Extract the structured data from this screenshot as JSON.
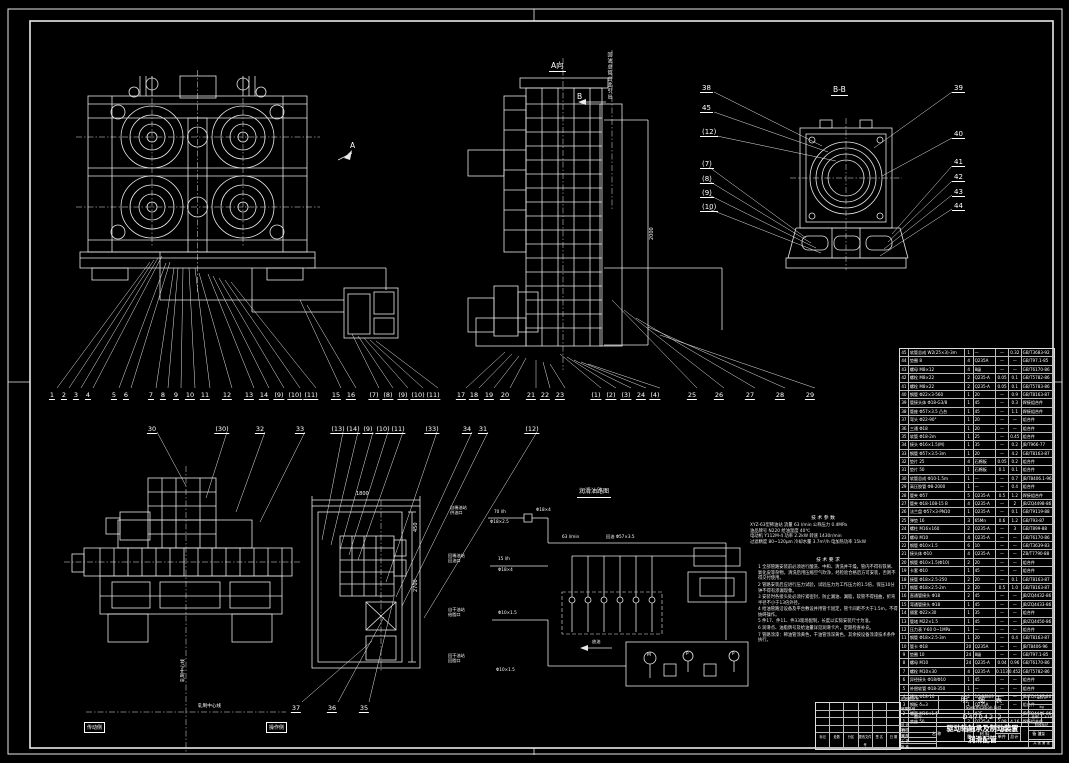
{
  "labels": {
    "view_a_title": "A向",
    "view_a_arrow": "A",
    "section_b_mark": "B",
    "section_bb_title": "B-B",
    "vertical_note": "回油总管由此引出",
    "schematic_title": "润滑油路图",
    "drain": "放油",
    "pump_m": "M",
    "pump_p1": "P",
    "pump_p2": "P",
    "dim_panel_width": "1800",
    "dim_panel_height": "2700",
    "dim_panel_top": "450",
    "dim_tower": "2000",
    "centerline_h": "轧制中心线",
    "centerline_v": "轧制中心线",
    "side_left_box": "传动侧",
    "side_right_box": "操作侧"
  },
  "balloons": {
    "row1": [
      "1",
      "2",
      "3",
      "4",
      "5",
      "6",
      "7",
      "8",
      "9",
      "10",
      "11",
      "12",
      "13",
      "14",
      "(9)",
      "(10)",
      "(11)",
      "15",
      "16",
      "(7)",
      "(8)",
      "(9)",
      "(10)",
      "(11)",
      "17",
      "18",
      "19",
      "20",
      "21",
      "22",
      "23",
      "(1)",
      "(2)",
      "(3)",
      "24",
      "(4)",
      "25",
      "26",
      "27",
      "28",
      "29"
    ],
    "row2": [
      "30",
      "(30)",
      "32",
      "33",
      "(13)",
      "(14)",
      "(9)",
      "(10)",
      "(11)",
      "(33)",
      "34",
      "31",
      "(12)"
    ],
    "bottom": [
      "37",
      "36",
      "35"
    ],
    "bb_left": [
      "38",
      "45",
      "(12)",
      "(7)",
      "(8)",
      "(9)",
      "(10)"
    ],
    "bb_right": [
      "39",
      "40",
      "41",
      "42",
      "43",
      "44"
    ]
  },
  "tech_params": {
    "title": "技 术 参 数",
    "lines": [
      "XYZ-63型稀油站  流量 63 l/min  公称压力 0.4MPa",
      "油品牌号 N220  给油温度 40℃",
      "电动机 Y112M-4  功率 2.2kW  转速 1430r/min",
      "过滤精度 80~120μm  冷却水量 3.7m³/h  电加热功率 15kW"
    ]
  },
  "tech_notes": {
    "title": "技 术 要 求",
    "items": [
      "1 全部管路安装前必须进行酸洗、中和、清洗并干燥，管内不得有铁屑、氧化皮等杂物，清洗后用压缩空气吹净，经检验合格后方可安装，否则不得交付使用。",
      "2 管路安装后应进行压力试验，试验压力为工作压力的1.5倍，保压10分钟不得有渗漏现象。",
      "3 安装时各接头处必须拧紧密封，防止漏油、漏脂，软管不得扭曲，折弯半径不小于13倍外径。",
      "4 给油管路沿设备及平台敷设并用管卡固定，管卡间距不大于1.5m，不得妨碍操作。",
      "5 件17、件11、件33现场配制，长度以实际安装尺寸为准。",
      "6 润滑点、油脂牌号及给油量详见润滑卡片，定期检查补充。",
      "7 管路涂漆：稀油管涂黄色，干油管涂深黄色，其余按设备涂漆技术条件执行。"
    ]
  },
  "schematic": {
    "sources": [
      {
        "l1": "自稀油站",
        "l2": "供油口"
      },
      {
        "l1": "回稀油站",
        "l2": "回油口"
      },
      {
        "l1": "自干油站",
        "l2": "给脂口"
      },
      {
        "l1": "回干油站",
        "l2": "回脂口"
      }
    ],
    "flow_labels": {
      "f1": "70 l/h",
      "p1": "Φ18×2.5",
      "p2": "Φ18×4",
      "f2": "63 l/min",
      "p3": "回油 Φ57×3.5",
      "f3": "15 l/h",
      "p4": "Φ18×4",
      "p5": "Φ10×1.5",
      "p6": "Φ10×1.5"
    }
  },
  "parts_table": {
    "headers": {
      "no": "件号",
      "name": "名  称",
      "qty": "数量",
      "mat": "材 料",
      "wt": "重量 kg",
      "w1": "单件",
      "w2": "总计",
      "rem": "备  注"
    },
    "rows": [
      {
        "no": "45",
        "name": "软管总成 W2(25×3)-3m",
        "qty": "1",
        "mat": "—",
        "w1": "—",
        "w2": "0.32",
        "rem": "GB/T3683-92"
      },
      {
        "no": "44",
        "name": "垫圈 8",
        "qty": "4",
        "mat": "Q235A",
        "w1": "—",
        "w2": "—",
        "rem": "GB/T97.1-85"
      },
      {
        "no": "43",
        "name": "螺母 M8×12",
        "qty": "4",
        "mat": "8级",
        "w1": "—",
        "w2": "—",
        "rem": "GB/T6170-86"
      },
      {
        "no": "42",
        "name": "螺栓 M8×22",
        "qty": "2",
        "mat": "Q235-A",
        "w1": "0.05",
        "w2": "0.1",
        "rem": "GB/T5782-86"
      },
      {
        "no": "41",
        "name": "螺栓 M8×22",
        "qty": "2",
        "mat": "Q235-A",
        "w1": "0.05",
        "w2": "0.1",
        "rem": "GB/T5783-86"
      },
      {
        "no": "40",
        "name": "钢管 Φ22×3-560",
        "qty": "1",
        "mat": "20",
        "w1": "—",
        "w2": "0.9",
        "rem": "GB/T8163-87"
      },
      {
        "no": "39",
        "name": "管接头体 Φ18-G3/8",
        "qty": "1",
        "mat": "45",
        "w1": "—",
        "w2": "0.3",
        "rem": "焊接组合件"
      },
      {
        "no": "38",
        "name": "管座 Φ57×3.5 凸台",
        "qty": "1",
        "mat": "45",
        "w1": "—",
        "w2": "1.1",
        "rem": "焊接组合件"
      },
      {
        "no": "37",
        "name": "弯头 Φ22-90°",
        "qty": "1",
        "mat": "20",
        "w1": "—",
        "w2": "—",
        "rem": "组合件"
      },
      {
        "no": "36",
        "name": "三通 Φ18",
        "qty": "1",
        "mat": "20",
        "w1": "—",
        "w2": "—",
        "rem": "组合件"
      },
      {
        "no": "35",
        "name": "软管 Φ18-2m",
        "qty": "1",
        "mat": "25",
        "w1": "—",
        "w2": "0.45",
        "rem": "组合件"
      },
      {
        "no": "34",
        "name": "接头 Φ16×1.5(M)",
        "qty": "1",
        "mat": "35",
        "w1": "—",
        "w2": "0.2",
        "rem": "JB/T966-77"
      },
      {
        "no": "33",
        "name": "钢管 Φ57×3.5-3m",
        "qty": "1",
        "mat": "20",
        "w1": "—",
        "w2": "4.2",
        "rem": "GB/T8163-87"
      },
      {
        "no": "32",
        "name": "垫片 25",
        "qty": "4",
        "mat": "石棉板",
        "w1": "0.05",
        "w2": "0.2",
        "rem": "组合件"
      },
      {
        "no": "31",
        "name": "垫片 50",
        "qty": "1",
        "mat": "石棉板",
        "w1": "0.1",
        "w2": "0.1",
        "rem": "组合件"
      },
      {
        "no": "30",
        "name": "软管总成 Φ10-1.5m",
        "qty": "1",
        "mat": "—",
        "w1": "—",
        "w2": "0.7",
        "rem": "JB/T8406.1-96"
      },
      {
        "no": "29",
        "name": "高压胶管 Φ8-2000",
        "qty": "1",
        "mat": "—",
        "w1": "—",
        "w2": "0.4",
        "rem": "组合件"
      },
      {
        "no": "28",
        "name": "管夹 Φ57",
        "qty": "5",
        "mat": "Q235-A",
        "w1": "0.5",
        "w2": "1.2",
        "rem": "焊接组合件"
      },
      {
        "no": "27",
        "name": "管夹 Φ18-108-15 B",
        "qty": "4",
        "mat": "Q235-A",
        "w1": "—",
        "w2": "2",
        "rem": "JB/ZQ4498-86"
      },
      {
        "no": "26",
        "name": "法兰盘 Φ57×3-PN10",
        "qty": "1",
        "mat": "Q235-A",
        "w1": "—",
        "w2": "0.1",
        "rem": "GB/T9119-88"
      },
      {
        "no": "25",
        "name": "弹垫 16",
        "qty": "3",
        "mat": "65Mn",
        "w1": "0.6",
        "w2": "1.2",
        "rem": "GB/T93-87"
      },
      {
        "no": "24",
        "name": "螺柱 M16×160",
        "qty": "2",
        "mat": "Q235-A",
        "w1": "—",
        "w2": "3",
        "rem": "GB/T899-88"
      },
      {
        "no": "23",
        "name": "螺母 M10",
        "qty": "4",
        "mat": "Q235-A",
        "w1": "—",
        "w2": "—",
        "rem": "GB/T6170-86"
      },
      {
        "no": "22",
        "name": "钢管 Φ10×1.5",
        "qty": "6",
        "mat": "10",
        "w1": "—",
        "w2": "—",
        "rem": "GB/T3639-83"
      },
      {
        "no": "21",
        "name": "接头体 Φ10",
        "qty": "4",
        "mat": "Q235-A",
        "w1": "—",
        "w2": "—",
        "rem": "ZB/T7790-88"
      },
      {
        "no": "20",
        "name": "钢管 Φ10×1.5(Φ10)",
        "qty": "2",
        "mat": "20",
        "w1": "—",
        "w2": "—",
        "rem": "组合件"
      },
      {
        "no": "19",
        "name": "卡套 Φ10",
        "qty": "1",
        "mat": "45",
        "w1": "—",
        "w2": "—",
        "rem": "组合件"
      },
      {
        "no": "18",
        "name": "接管 Φ18×2.5-250",
        "qty": "2",
        "mat": "20",
        "w1": "—",
        "w2": "0.1",
        "rem": "GB/T8163-87"
      },
      {
        "no": "17",
        "name": "钢管 Φ18×2.5-2m",
        "qty": "2",
        "mat": "20",
        "w1": "0.5",
        "w2": "1.0",
        "rem": "GB/T8163-87"
      },
      {
        "no": "16",
        "name": "直通管接头 Φ18",
        "qty": "2",
        "mat": "45",
        "w1": "—",
        "w2": "—",
        "rem": "JB/ZQ4432-86"
      },
      {
        "no": "15",
        "name": "弯通管接头 Φ18",
        "qty": "1",
        "mat": "45",
        "w1": "—",
        "w2": "—",
        "rem": "JB/ZQ4433-86"
      },
      {
        "no": "14",
        "name": "隔套 Φ22×30",
        "qty": "1",
        "mat": "35",
        "w1": "—",
        "w2": "—",
        "rem": "组合件"
      },
      {
        "no": "13",
        "name": "管堵 M22×1.5",
        "qty": "1",
        "mat": "45",
        "w1": "—",
        "w2": "—",
        "rem": "JB/ZQ4450-86"
      },
      {
        "no": "12",
        "name": "压力表 Y-60 0~1MPa",
        "qty": "1",
        "mat": "—",
        "w1": "—",
        "w2": "—",
        "rem": "组合件"
      },
      {
        "no": "11",
        "name": "钢管 Φ18×2.5-3m",
        "qty": "1",
        "mat": "20",
        "w1": "—",
        "w2": "0.4",
        "rem": "GB/T8163-87"
      },
      {
        "no": "10",
        "name": "管卡 Φ18",
        "qty": "20",
        "mat": "Q235A",
        "w1": "—",
        "w2": "—",
        "rem": "JB/T8406-96"
      },
      {
        "no": "9",
        "name": "垫圈 10",
        "qty": "24",
        "mat": "8级",
        "w1": "—",
        "w2": "—",
        "rem": "GB/T97.1-85"
      },
      {
        "no": "8",
        "name": "螺母 M10",
        "qty": "24",
        "mat": "Q235-A",
        "w1": "0.04",
        "w2": "0.96",
        "rem": "GB/T6170-86"
      },
      {
        "no": "7",
        "name": "螺栓 M10×30",
        "qty": "4",
        "mat": "Q235-A",
        "w1": "0.113",
        "w2": "0.452",
        "rem": "GB/T5782-86"
      },
      {
        "no": "6",
        "name": "异径接头 Φ18/Φ10",
        "qty": "1",
        "mat": "45",
        "w1": "—",
        "w2": "—",
        "rem": "组合件"
      },
      {
        "no": "5",
        "name": "补偿软管 Φ18-350",
        "qty": "1",
        "mat": "—",
        "w1": "—",
        "w2": "—",
        "rem": "组合件"
      },
      {
        "no": "4",
        "name": "接头 Φ18-10",
        "qty": "2",
        "mat": "1Cr18Ni9",
        "w1": "—",
        "w2": "—",
        "rem": "JB/ZQ4187-86"
      },
      {
        "no": "3",
        "name": "钢板 δ=3",
        "qty": "1",
        "mat": "Q235A",
        "w1": "—",
        "w2": "—",
        "rem": "组合件"
      },
      {
        "no": "2",
        "name": "螺塞 M16×1.5",
        "qty": "1",
        "mat": "A3F",
        "w1": "—",
        "w2": "—",
        "rem": "JB/ZQ4446-86"
      },
      {
        "no": "1",
        "name": "底座 50",
        "qty": "2",
        "mat": "Q235-A",
        "w1": "2.08",
        "w2": "4.16",
        "rem": "焊接组合件"
      }
    ]
  },
  "spec_block": {
    "left_small_1": "旧底图总号",
    "left_small_2": "底图总号",
    "cn": "明 细 表",
    "en": "Specification List",
    "right_top": "40TH",
    "right_unit": "kg",
    "dwg_label": "图号",
    "dwg_no": "D47042-2",
    "scale_label": "比例",
    "scale_value": "1:10",
    "title1": "驱动轴轴承及制动装置",
    "title2": "润滑配管"
  },
  "title_block": {
    "rev_labels": [
      "标记",
      "处数",
      "分区",
      "更改文件号",
      "签 名",
      "日 期"
    ],
    "sig_labels": [
      "设 计",
      "制 图",
      "审 核",
      "工 艺",
      "批 准"
    ],
    "stage_label": "阶段标记",
    "weight_label": "重量",
    "sheet_label": "共 张 第 张"
  }
}
